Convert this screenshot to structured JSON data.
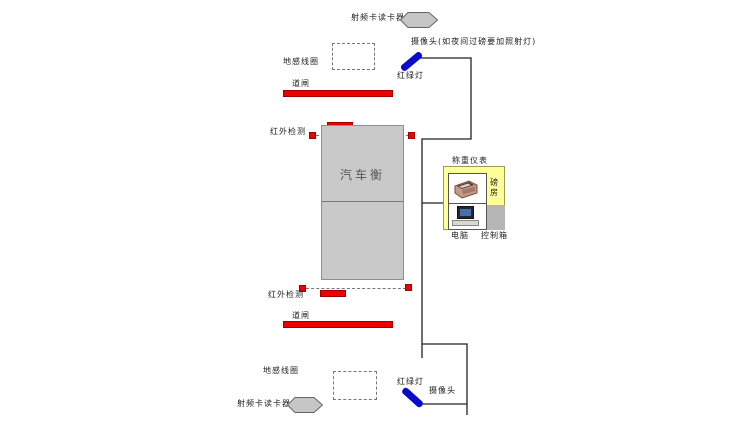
{
  "colors": {
    "red": "#ee0000",
    "blue": "#0a0acc",
    "scale_gray": "#c9c9c9",
    "hexagon_gray": "#c6c6c6",
    "room_yellow": "#ffff99",
    "control_box_gray": "#b5b5b5",
    "wire": "#222222"
  },
  "top_lane": {
    "rfid_reader": "射频卡读卡器",
    "camera_note": "摄像头(如夜间过磅要加照射灯)",
    "ground_coil": "地感线圈",
    "traffic_light": "红绿灯",
    "barrier": "道闸",
    "infrared": "红外检测"
  },
  "scale": {
    "label": "汽车衡"
  },
  "weigh_room": {
    "indicator": "称重仪表",
    "room": "磅房",
    "computer": "电脑",
    "control_box": "控制箱"
  },
  "bottom_lane": {
    "infrared": "红外检测",
    "barrier": "道闸",
    "ground_coil": "地感线圈",
    "rfid_reader": "射频卡读卡器",
    "traffic_light": "红绿灯",
    "camera": "摄像头"
  }
}
